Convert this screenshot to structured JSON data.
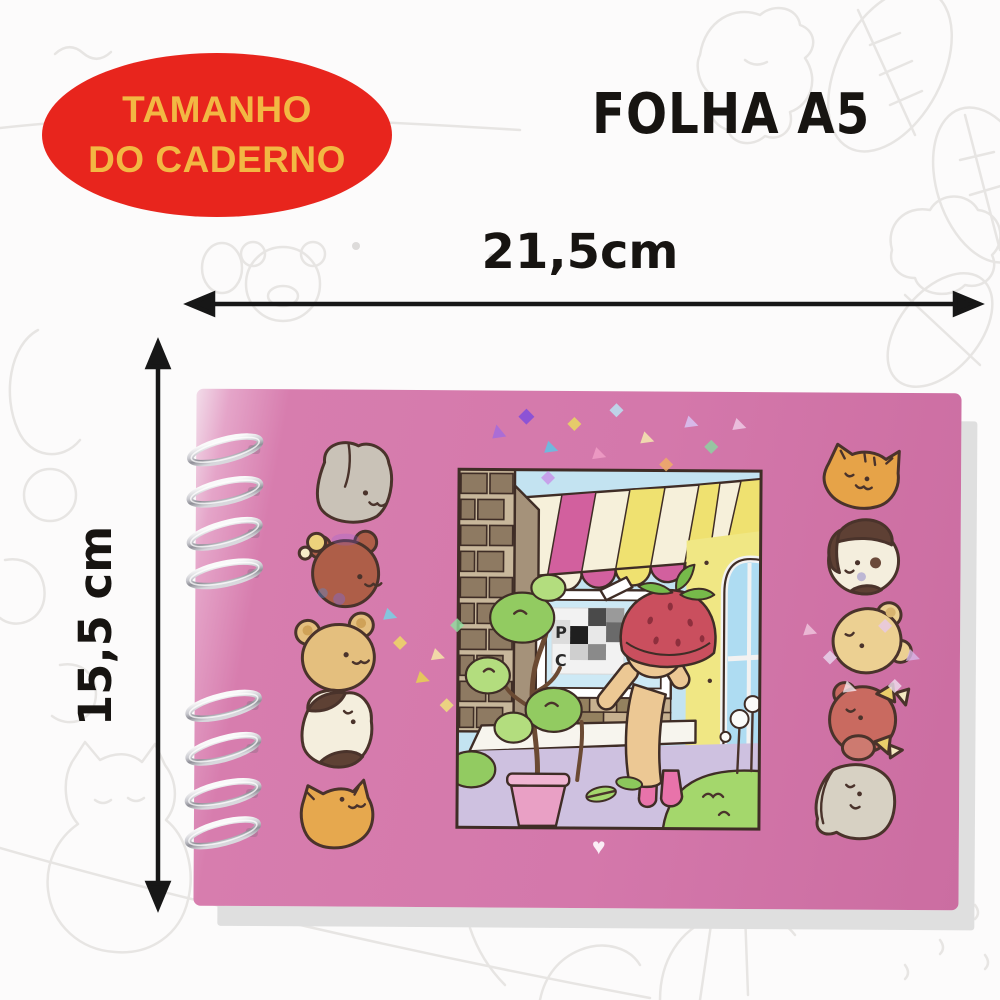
{
  "badge": {
    "line1": "TAMANHO",
    "line2": "DO CADERNO"
  },
  "sheet_label": "FOLHA A5",
  "dimensions": {
    "width": "21,5cm",
    "height": "15,5 cm"
  },
  "notebook": {
    "heart": "♥",
    "sign": {
      "letter_top": "P",
      "letter_bottom": "C"
    },
    "left_animals": [
      "gray-bunny",
      "brown-bear-with-bow",
      "tan-bear",
      "brown-spotted-cat",
      "orange-cat"
    ],
    "right_animals": [
      "orange-tabby-cat",
      "white-dog-brown-ears",
      "cream-bear",
      "red-bear-with-bows",
      "gray-puppy"
    ]
  },
  "colors": {
    "badge_bg": "#e8251d",
    "badge_text": "#f2b843",
    "label_text": "#171411",
    "arrow": "#171717",
    "cover_pink": "#d478ab",
    "panel_sky": "#c3e3f1",
    "awning_yellow": "#efe170",
    "awning_pink": "#d2609e",
    "hat_red": "#ca4f5e",
    "grass_green": "#a4d76c",
    "boot_pink": "#e873aa",
    "spiral_silver": "#c9c9cf"
  }
}
